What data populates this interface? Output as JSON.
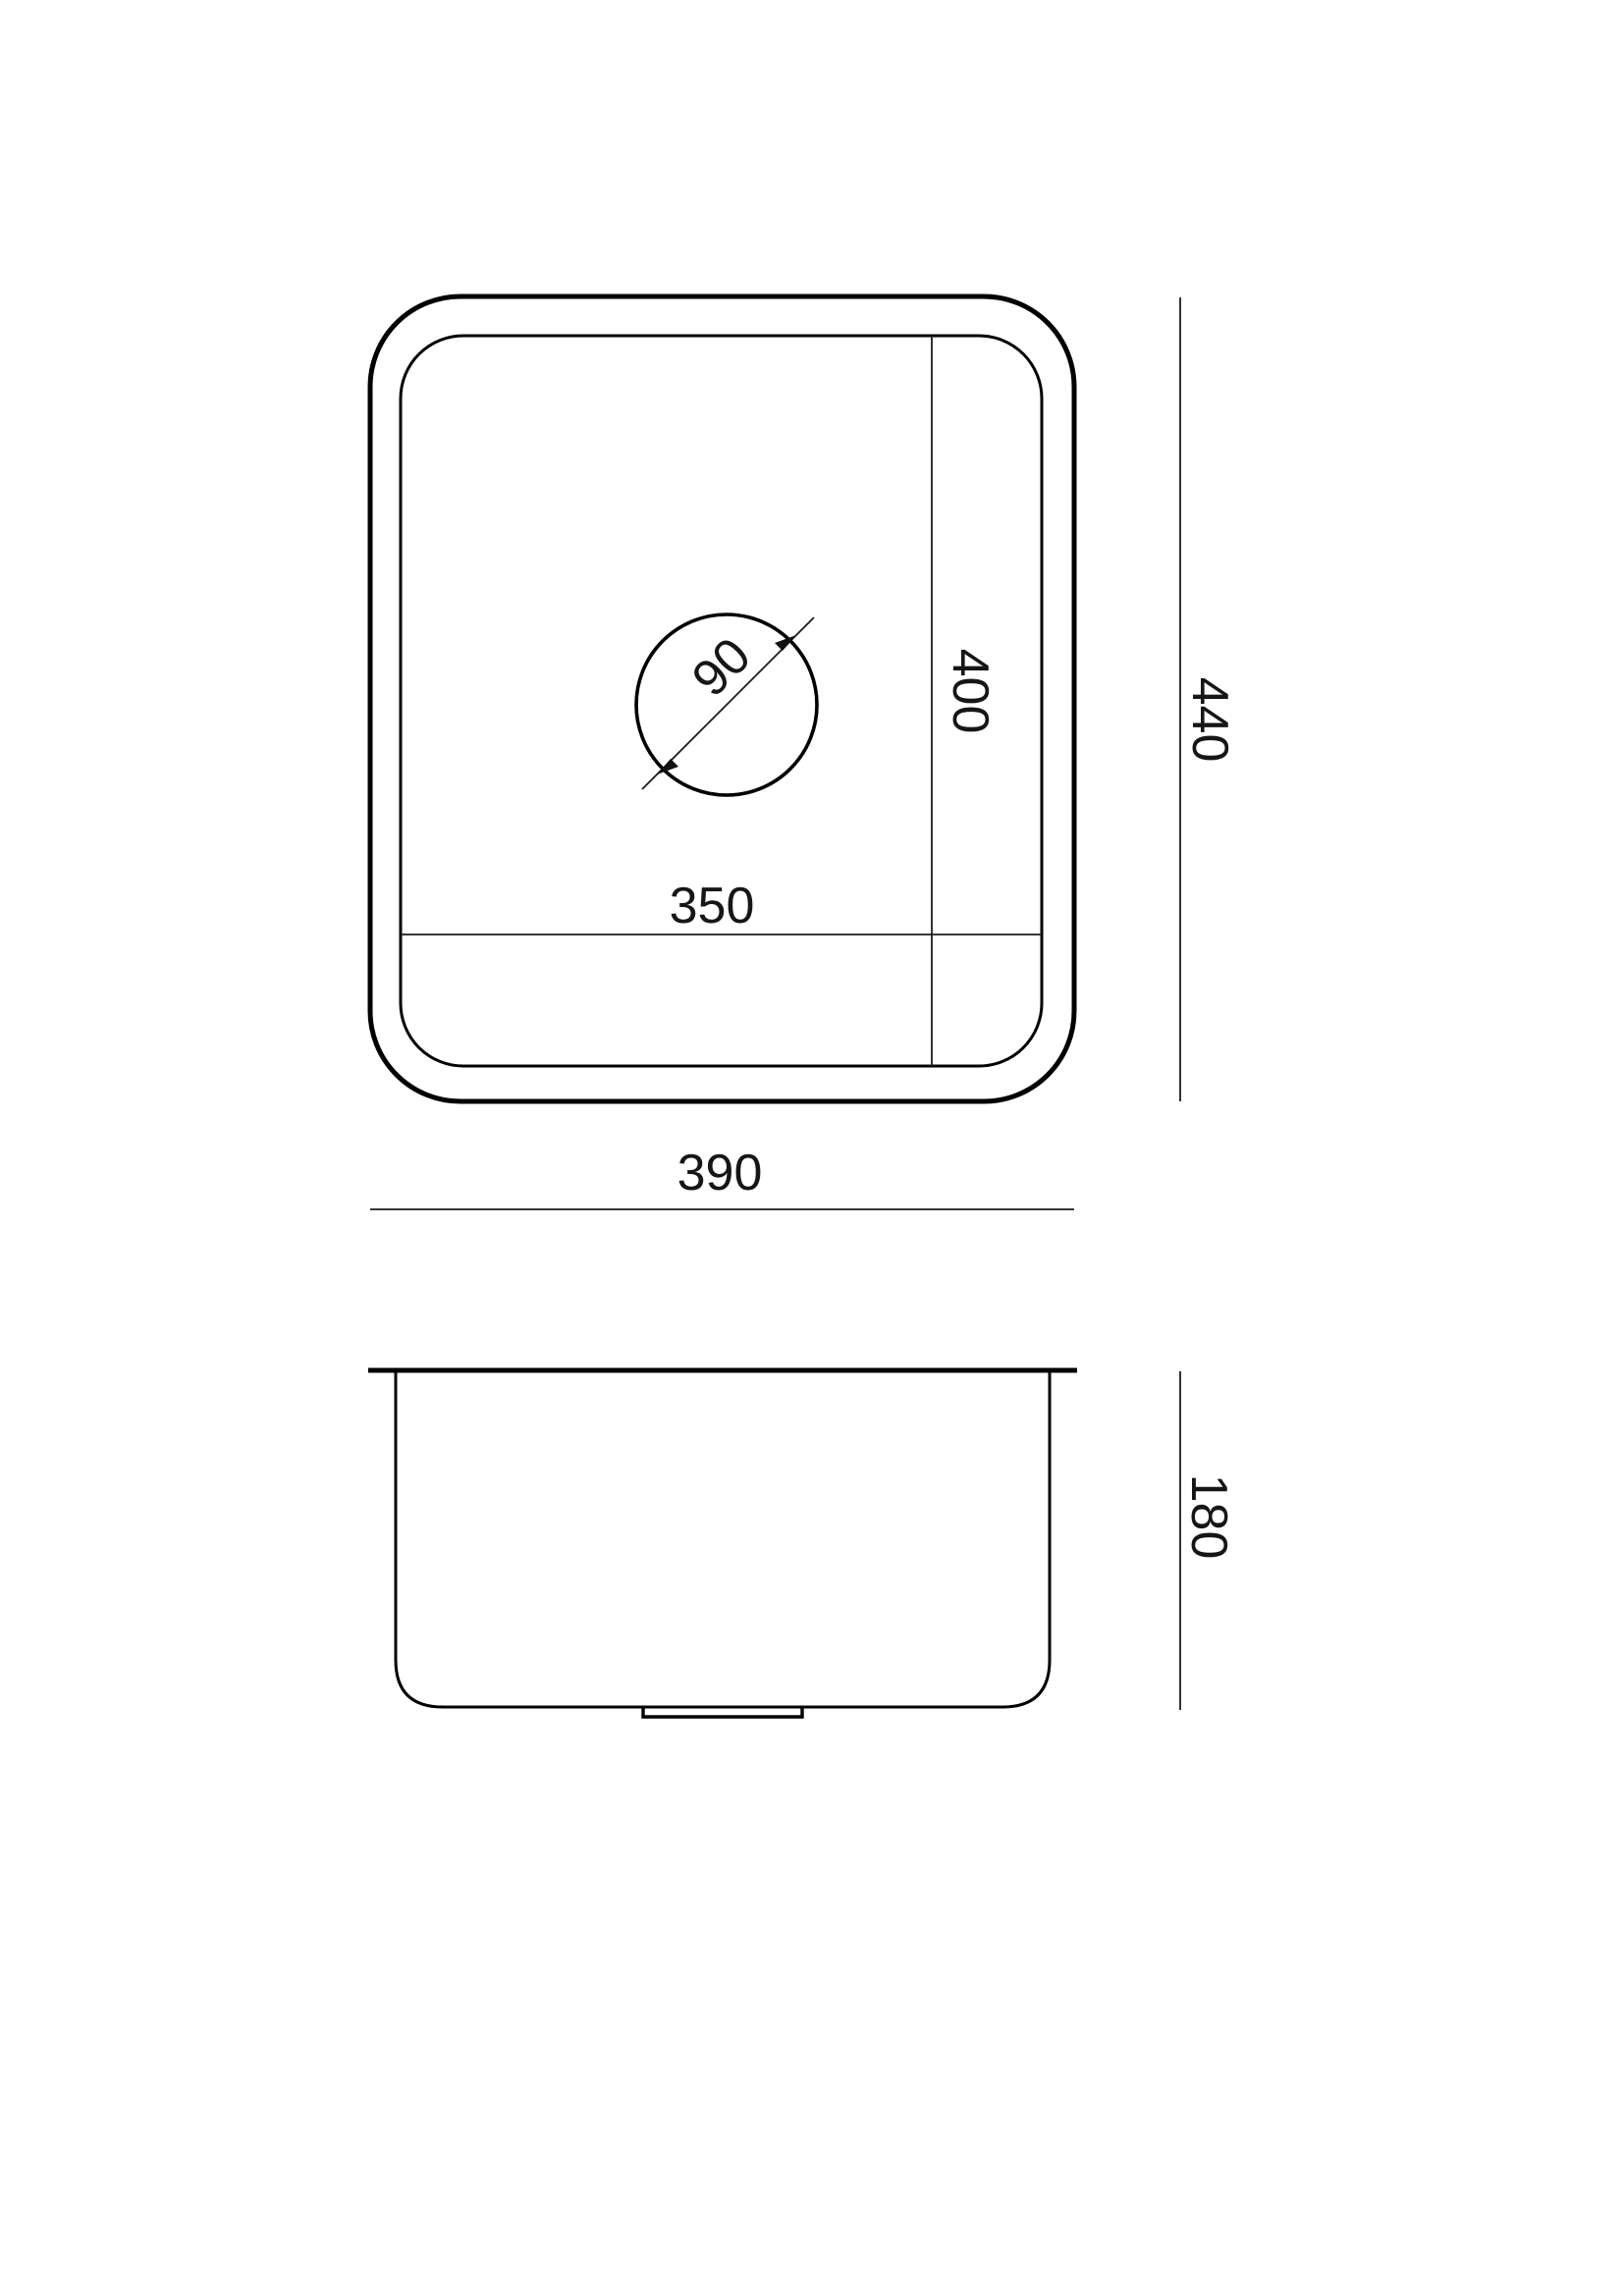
{
  "drawing": {
    "background_color": "#ffffff",
    "line_color": "#000000",
    "dimension_text_color": "#161616",
    "views": {
      "top": {
        "name": "sink top view",
        "dims": {
          "drain_diameter": "90",
          "bowl_length": "400",
          "bowl_width": "350",
          "overall_length": "440",
          "overall_width": "390"
        }
      },
      "side": {
        "name": "sink front elevation",
        "dims": {
          "bowl_height": "180"
        }
      }
    }
  }
}
